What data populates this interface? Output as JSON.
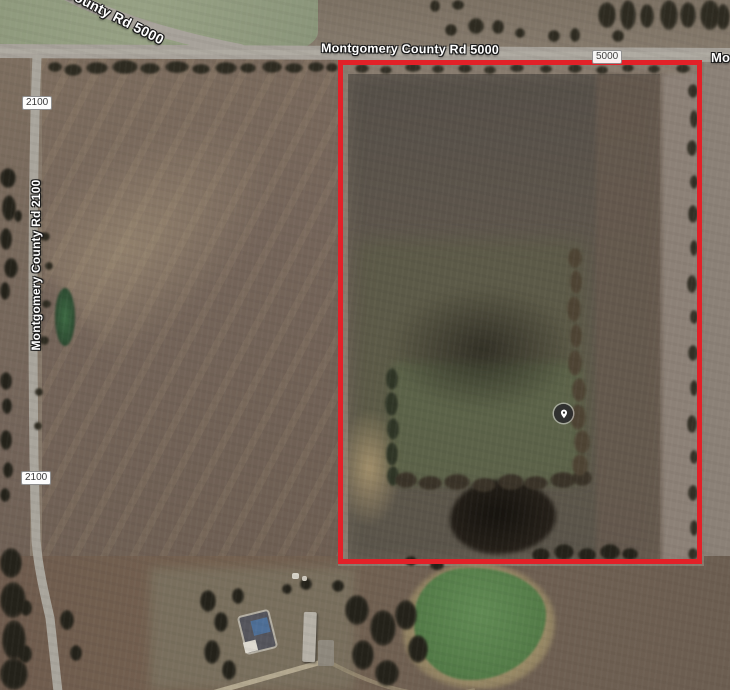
{
  "map": {
    "road_labels": {
      "top_diagonal": "County Rd 5000",
      "top_horizontal": "Montgomery County Rd 5000",
      "top_right_clipped": "Mo",
      "left_vertical": "Montgomery County Rd 2100"
    },
    "route_badges": {
      "badge_5000": "5000",
      "badge_2100_upper": "2100",
      "badge_2100_lower": "2100"
    },
    "parcel": {
      "outline_color": "#e22128"
    },
    "marker": {
      "icon": "location-pin"
    },
    "colors": {
      "road": "#a7a29a",
      "plowed_field": "#5e564c",
      "left_field": "#75655a",
      "green_pond": "#567e4a"
    }
  }
}
